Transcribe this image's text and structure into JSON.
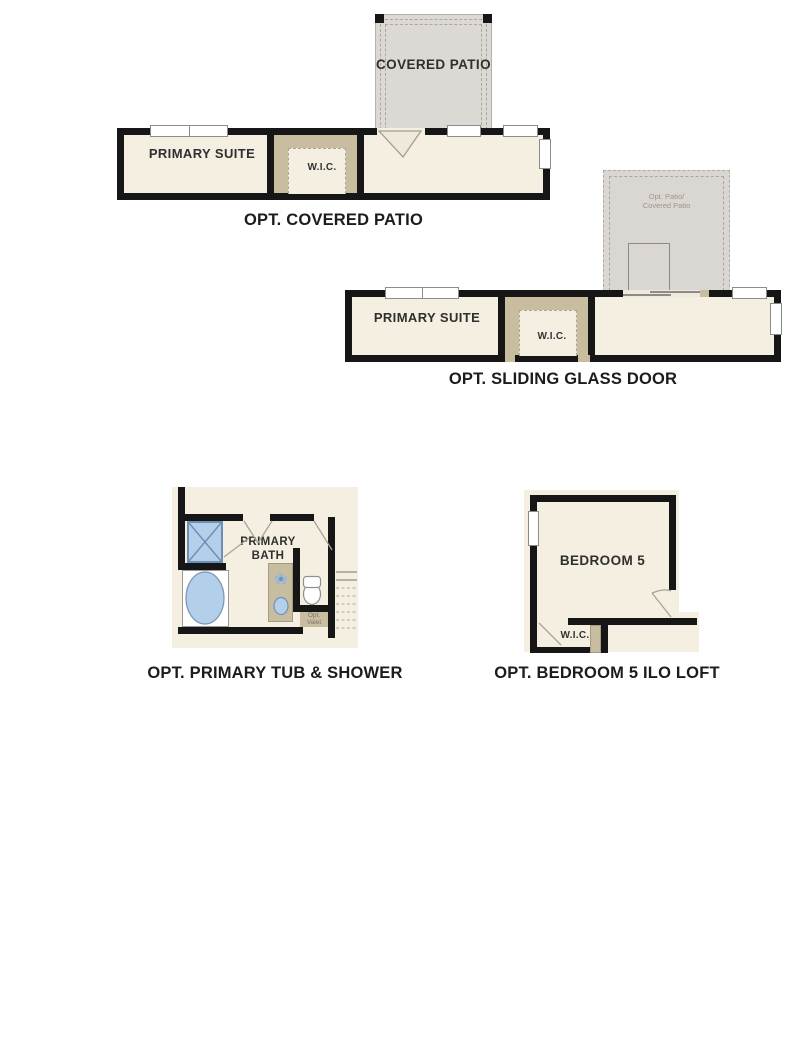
{
  "document": {
    "type": "floor-plan-option-sheet",
    "background": "#ffffff"
  },
  "colors": {
    "wall": "#161616",
    "room_fill": "#f4efe1",
    "closet_tan": "#c9bda0",
    "patio_gray": "#dcd8d3",
    "patio_gray_light": "#dad7d2",
    "fixture_blue": "#b3cfe9",
    "fixture_blue_line": "#6d8fb3",
    "door_line_gray": "#a8a298",
    "caption_text": "#1c1c1c",
    "faint_text": "#9b968c"
  },
  "plans": [
    {
      "id": "covered-patio",
      "caption": "OPT. COVERED PATIO",
      "outdoor": "COVERED PATIO",
      "rooms": [
        "PRIMARY SUITE",
        "W.I.C."
      ]
    },
    {
      "id": "sliding-glass-door",
      "caption": "OPT. SLIDING GLASS DOOR",
      "outdoor_line1": "Opt. Patio/",
      "outdoor_line2": "Covered Patio",
      "rooms": [
        "PRIMARY SUITE",
        "W.I.C."
      ]
    },
    {
      "id": "primary-tub-shower",
      "caption": "OPT. PRIMARY TUB & SHOWER",
      "room": "PRIMARY BATH",
      "note_line1": "Opt.",
      "note_line2": "Valet"
    },
    {
      "id": "bedroom5-ilo-loft",
      "caption": "OPT. BEDROOM 5 ILO LOFT",
      "rooms": [
        "BEDROOM 5",
        "W.I.C."
      ]
    }
  ]
}
